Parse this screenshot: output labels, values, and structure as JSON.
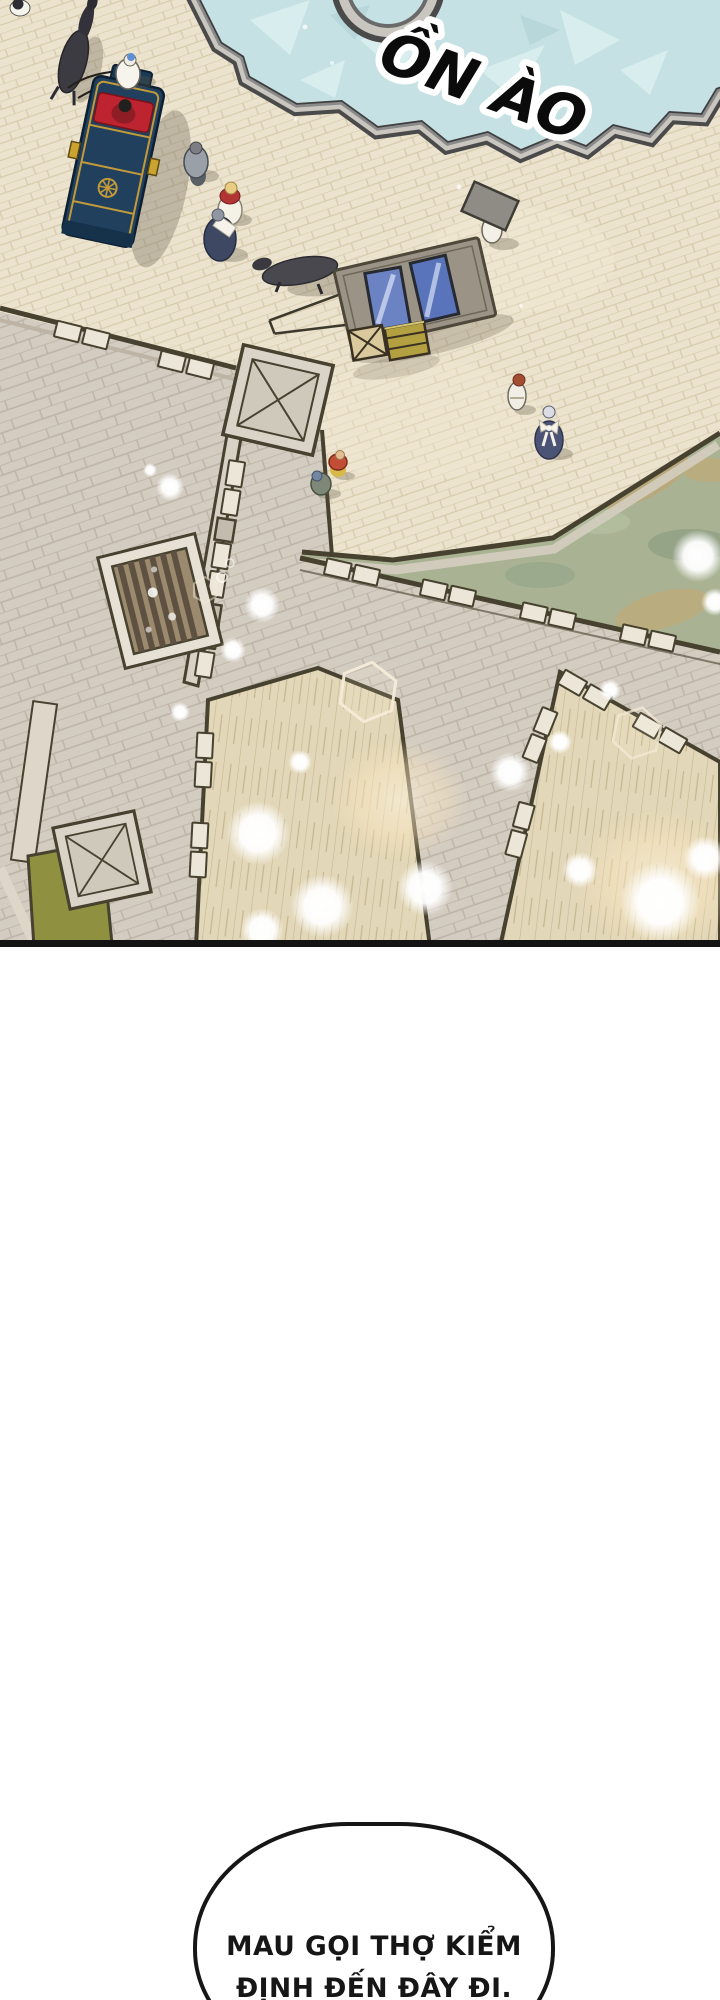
{
  "panel": {
    "sfx_text": "ỒN ÀO"
  },
  "speech_bubble": {
    "line1": "MAU GỌI THỢ KIỂM",
    "line2": "ĐỊNH ĐẾN ĐÂY ĐI."
  },
  "colors": {
    "page_bg": "#ffffff",
    "pavement": "#ebe3cd",
    "pavement_line": "#d7cbae",
    "roof": "#d3ccc1",
    "roof_line": "#bcb3a5",
    "wall_dark": "#47412f",
    "merlon": "#ece6d8",
    "water": "#a9b293",
    "fountain_water": "#c5e1e4",
    "fountain_rim_light": "#c9c6c0",
    "fountain_rim_dark": "#4a4a4a",
    "plank": "#e2d7b8",
    "plank_line": "#c6b68e",
    "grass": "#8f9140",
    "carriage_body": "#20405e",
    "carriage_trim": "#c39a3a",
    "carriage_seat": "#bd2430",
    "glass_panel": "#6c83c3",
    "crate_wood": "#d9c99d",
    "crate_olive": "#b3a041",
    "grate_wood": "#9b8a6e",
    "sfx_fill": "#0b0b0b",
    "sfx_outline": "#ffffff",
    "bubble_border": "#161616",
    "bubble_text": "#161616"
  }
}
